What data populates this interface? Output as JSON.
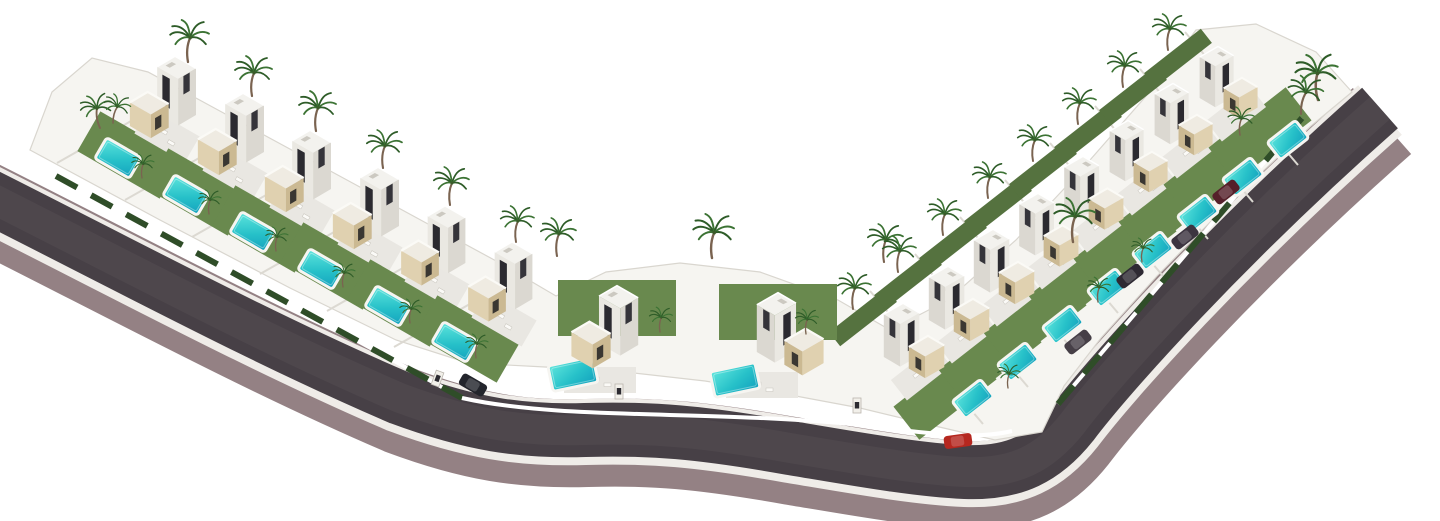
{
  "title": "Aerial 3D render of a V-shaped villa development: 16 modern white villas with stone-clad cubes, turquoise pools, palm trees and lawns along a curved asphalt road",
  "canvas": {
    "w": 1440,
    "h": 521,
    "bg": "#ffffff"
  },
  "palette": {
    "land": "#f6f5f1",
    "land_edge": "#d9d6cf",
    "asphalt": "#474046",
    "asphalt_sheen": "#534c52",
    "casing": "#948184",
    "sidewalk": "#efece8",
    "lawn": "#69894e",
    "lawn2": "#55723f",
    "patio": "#e9e7e2",
    "hedge": "#2f4d28",
    "wall": "#ffffff",
    "separator": "#dcd9d2",
    "pool_light": "#53e0da",
    "pool_deep": "#14a3bd",
    "pool_rim": "#f6f5f1",
    "trunk": "#7a6350",
    "frond": "#2e5c28",
    "frond2": "#3c7334",
    "speck": "#fbfaf7",
    "speck_edge": "#c8c5bd"
  },
  "road": {
    "path": "M -40,182 C 120,262 260,338 400,398 C 470,424 520,432 585,430 C 650,428 700,432 790,448 C 845,457 915,470 965,472 C 1015,474 1045,458 1072,424 C 1108,376 1225,245 1380,108",
    "casing_w": 88,
    "sidewalk_w": 66,
    "asphalt_w": 54,
    "sheen_w": 30,
    "casing_dx": 2,
    "casing_dy": 13
  },
  "land": {
    "path": "M 30,150 L 160,220 L 290,288 L 396,340 L 468,363 L 545,367 L 625,372 L 705,381 L 785,394 L 860,408 L 935,426 L 995,440 L 1042,432 L 1064,386 L 1101,338 L 1157,276 L 1228,204 L 1311,126 L 1352,92 L 1316,52 L 1256,24 L 1196,30 L 1147,95 L 1076,176 L 1016,240 L 948,300 L 890,330 L 838,300 L 760,272 L 680,263 L 606,272 L 556,296 L 498,262 L 428,224 L 358,186 L 288,148 L 218,110 L 148,72 L 92,58 L 52,92 Z"
  },
  "walls": {
    "left": "M 56,176 L 462,398",
    "center": "M 462,398 C 560,420 700,410 850,424 C 920,432 970,441 1012,431",
    "right": "M 1058,404 L 1302,118"
  },
  "wings": {
    "L": {
      "rot": 30,
      "pool": [
        -57,
        43,
        40,
        24
      ],
      "lawn": [
        -45,
        40,
        95,
        46
      ],
      "patio": [
        -8,
        20,
        58,
        30
      ],
      "sep": [
        [
          -118,
          48
        ],
        [
          2,
          -20
        ]
      ]
    },
    "R": {
      "rot": -38,
      "pool": [
        70,
        42,
        36,
        22
      ],
      "lawn": [
        42,
        36,
        98,
        42
      ],
      "patio": [
        18,
        16,
        56,
        26
      ],
      "back": [
        -40,
        -40,
        72,
        18
      ],
      "sep": [
        [
          -33,
          -66
        ],
        [
          80,
          67
        ]
      ]
    }
  },
  "villas": [
    {
      "x": 175,
      "y": 115,
      "w": "L",
      "s": 1.05,
      "f": 0
    },
    {
      "x": 243,
      "y": 152,
      "w": "L",
      "s": 1.05,
      "f": 0
    },
    {
      "x": 310,
      "y": 189,
      "w": "L",
      "s": 1.05,
      "f": 0
    },
    {
      "x": 378,
      "y": 226,
      "w": "L",
      "s": 1.05,
      "f": 0
    },
    {
      "x": 445,
      "y": 263,
      "w": "L",
      "s": 1.02,
      "f": 0
    },
    {
      "x": 512,
      "y": 299,
      "w": "L",
      "s": 1.02,
      "f": 0
    },
    {
      "x": 617,
      "y": 345,
      "w": "C",
      "s": 1.06,
      "f": 0
    },
    {
      "x": 778,
      "y": 352,
      "w": "C",
      "s": 1.06,
      "f": 1
    },
    {
      "x": 903,
      "y": 357,
      "w": "R",
      "s": 0.96,
      "f": 1
    },
    {
      "x": 948,
      "y": 320,
      "w": "R",
      "s": 0.96,
      "f": 1
    },
    {
      "x": 993,
      "y": 283,
      "w": "R",
      "s": 0.96,
      "f": 1
    },
    {
      "x": 1038,
      "y": 246,
      "w": "R",
      "s": 0.94,
      "f": 1
    },
    {
      "x": 1083,
      "y": 209,
      "w": "R",
      "s": 0.94,
      "f": 1
    },
    {
      "x": 1128,
      "y": 172,
      "w": "R",
      "s": 0.92,
      "f": 1
    },
    {
      "x": 1173,
      "y": 135,
      "w": "R",
      "s": 0.92,
      "f": 1
    },
    {
      "x": 1218,
      "y": 98,
      "w": "R",
      "s": 0.92,
      "f": 1
    }
  ],
  "center_extras": {
    "pools": [
      [
        573,
        374,
        -12,
        46,
        26
      ],
      [
        735,
        380,
        -12,
        46,
        26
      ]
    ],
    "lawns": [
      [
        617,
        308,
        0,
        118,
        56
      ],
      [
        778,
        312,
        0,
        118,
        56
      ]
    ],
    "patios": [
      [
        600,
        380,
        0,
        72,
        26
      ],
      [
        762,
        385,
        0,
        72,
        26
      ]
    ]
  },
  "palms": [
    [
      100,
      128,
      0.85,
      -14
    ],
    [
      113,
      123,
      0.72,
      10
    ],
    [
      188,
      62,
      1.05,
      0
    ],
    [
      252,
      96,
      1.0,
      0
    ],
    [
      316,
      131,
      1.0,
      0
    ],
    [
      383,
      168,
      0.95,
      0
    ],
    [
      450,
      205,
      0.95,
      0
    ],
    [
      516,
      242,
      0.9,
      0
    ],
    [
      142,
      178,
      0.6,
      0
    ],
    [
      209,
      214,
      0.6,
      0
    ],
    [
      276,
      251,
      0.6,
      0
    ],
    [
      343,
      287,
      0.6,
      0
    ],
    [
      410,
      323,
      0.6,
      0
    ],
    [
      476,
      358,
      0.6,
      0
    ],
    [
      557,
      256,
      0.95,
      0
    ],
    [
      712,
      258,
      1.1,
      0
    ],
    [
      660,
      332,
      0.62,
      0
    ],
    [
      806,
      334,
      0.62,
      0
    ],
    [
      884,
      262,
      0.95,
      0
    ],
    [
      853,
      309,
      0.9,
      0
    ],
    [
      898,
      272,
      0.9,
      0
    ],
    [
      943,
      235,
      0.9,
      0
    ],
    [
      988,
      198,
      0.9,
      0
    ],
    [
      1033,
      161,
      0.9,
      0
    ],
    [
      1078,
      124,
      0.9,
      0
    ],
    [
      1123,
      87,
      0.9,
      0
    ],
    [
      1168,
      50,
      0.9,
      0
    ],
    [
      1073,
      242,
      1.1,
      0
    ],
    [
      1318,
      100,
      1.15,
      -6
    ],
    [
      1301,
      114,
      0.95,
      8
    ],
    [
      1240,
      135,
      0.7,
      0
    ],
    [
      1008,
      388,
      0.6,
      0
    ],
    [
      1098,
      302,
      0.62,
      0
    ],
    [
      1142,
      262,
      0.6,
      0
    ]
  ],
  "cars": [
    {
      "x": 473,
      "y": 385,
      "rot": 30,
      "c": "#23252c"
    },
    {
      "x": 958,
      "y": 441,
      "rot": -8,
      "c": "#b5271f"
    },
    {
      "x": 1078,
      "y": 342,
      "rot": -38,
      "c": "#463f47"
    },
    {
      "x": 1130,
      "y": 276,
      "rot": -38,
      "c": "#2e2a33"
    },
    {
      "x": 1185,
      "y": 237,
      "rot": -38,
      "c": "#3c3440"
    },
    {
      "x": 1226,
      "y": 192,
      "rot": -38,
      "c": "#55202a"
    }
  ],
  "pillars": [
    [
      437,
      380,
      20
    ],
    [
      619,
      393,
      0
    ],
    [
      857,
      407,
      0
    ]
  ]
}
